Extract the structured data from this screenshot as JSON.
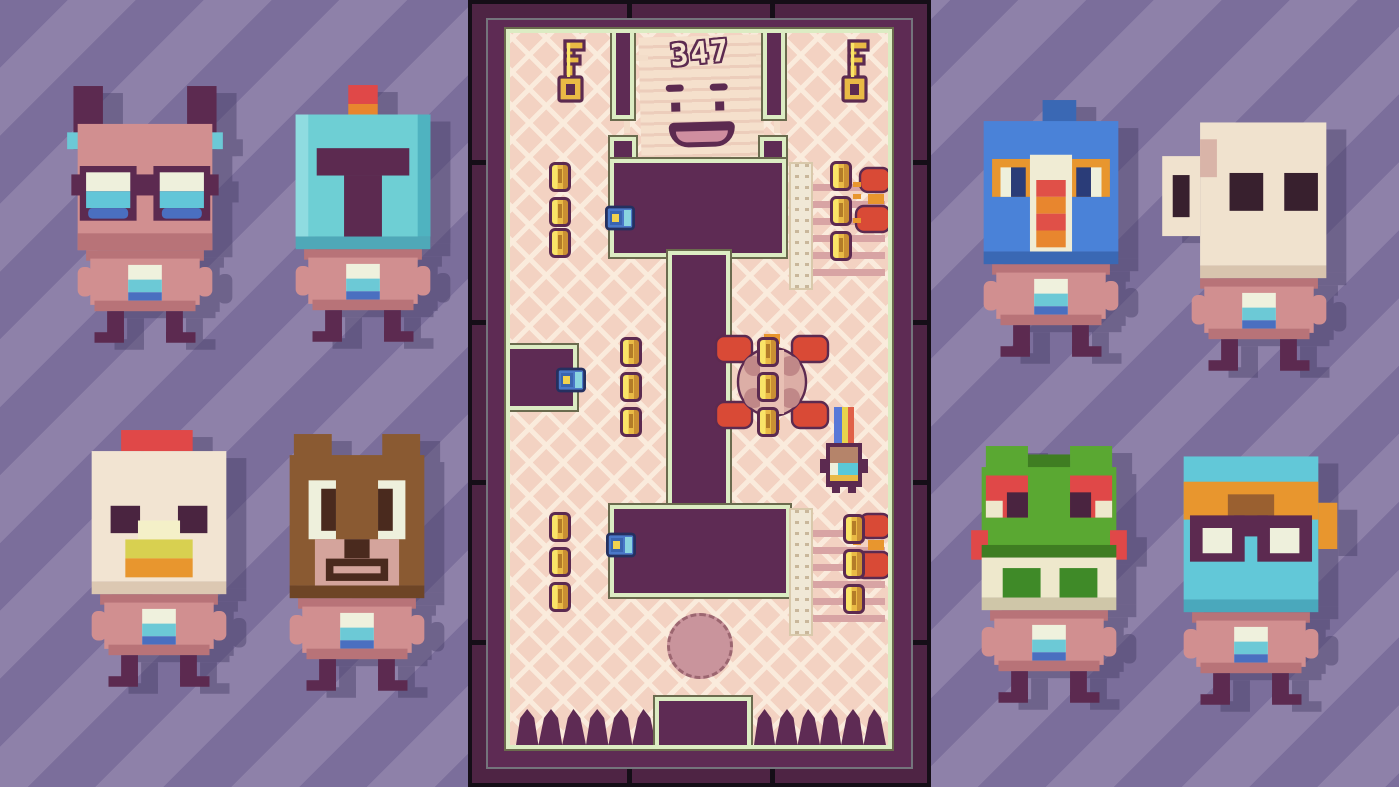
{
  "hud": {
    "score": "347"
  },
  "palette": {
    "stripe_dark": "#7b6e9b",
    "stripe_light": "#8e81a9",
    "wall": "#5e2b54",
    "frame": "#4e2444",
    "floor": "#f3d2c2",
    "floor_pattern": "#f9e8d8",
    "outline_green": "#dcecc3",
    "gold": "#e9ba45",
    "crab_red": "#d94a36",
    "body_pink": "#d18f90"
  },
  "roster": {
    "characters": [
      {
        "id": "bat-glasses",
        "label": "bat kid with goggles"
      },
      {
        "id": "knight",
        "label": "knight with red plume"
      },
      {
        "id": "chicken",
        "label": "chicken"
      },
      {
        "id": "bear",
        "label": "bear"
      },
      {
        "id": "mandrill",
        "label": "blue mandrill bird"
      },
      {
        "id": "mug",
        "label": "mug robot"
      },
      {
        "id": "frog",
        "label": "frog"
      },
      {
        "id": "diver",
        "label": "aviator with goggles"
      }
    ]
  },
  "level": {
    "keys": [
      [
        41,
        6
      ],
      [
        325,
        6
      ]
    ],
    "coins": [
      [
        39,
        129
      ],
      [
        39,
        164
      ],
      [
        39,
        195
      ],
      [
        110,
        304
      ],
      [
        110,
        339
      ],
      [
        110,
        374
      ],
      [
        39,
        479
      ],
      [
        39,
        514
      ],
      [
        39,
        549
      ],
      [
        247,
        304
      ],
      [
        247,
        339
      ],
      [
        247,
        374
      ],
      [
        320,
        128
      ],
      [
        320,
        163
      ],
      [
        320,
        198
      ],
      [
        333,
        481
      ],
      [
        333,
        516
      ],
      [
        333,
        551
      ]
    ],
    "snails": [
      [
        95,
        172
      ],
      [
        46,
        334
      ],
      [
        96,
        499
      ]
    ],
    "gates": [
      [
        279,
        129
      ],
      [
        279,
        475
      ]
    ],
    "crabs_small": [
      [
        342,
        133
      ],
      [
        342,
        479
      ]
    ],
    "crab_large": [
      [
        202,
        299
      ]
    ],
    "player": [
      [
        304,
        374
      ]
    ]
  }
}
